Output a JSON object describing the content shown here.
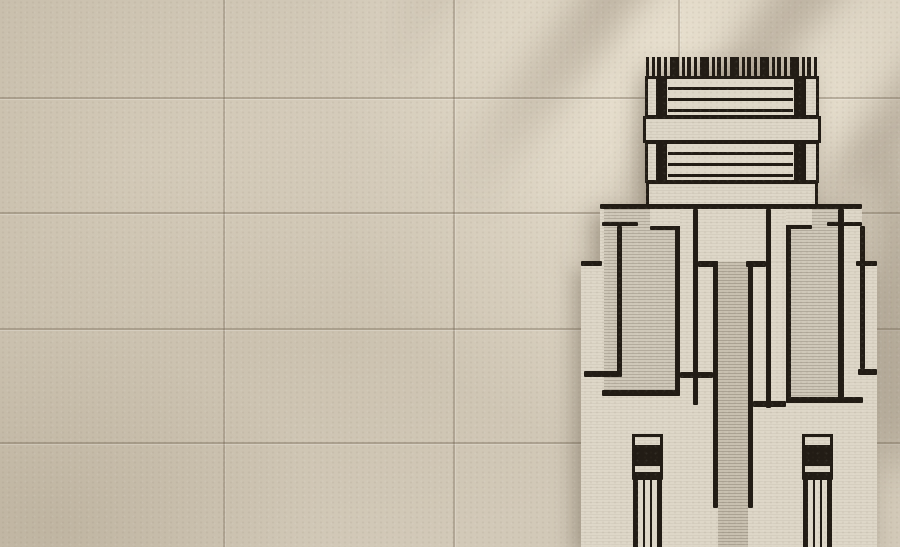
{
  "scene": {
    "description": "Beige limestone tile wall with a cream hand-tufted rug bearing a black Art Deco skyscraper motif",
    "colors": {
      "tile_base": "#d2c9b8",
      "tile_light": "#e8dfcd",
      "tile_dark": "#c7beac",
      "grout": "#746755",
      "rug_cream": "#ded7c8",
      "rug_ribbed": "#cfc8b9",
      "rug_ribbed_dark": "#c8c0b0",
      "rug_black": "#221c15"
    },
    "wall": {
      "grout_x": [
        223,
        453,
        678
      ],
      "grout_y": [
        97,
        212,
        328,
        442
      ]
    },
    "rug": {
      "left": 581,
      "top": 57,
      "right": 877,
      "bottom": 547,
      "rects": [
        {
          "name": "rug-body-shoulder",
          "x": 600,
          "y": 204,
          "w": 262,
          "h": 60,
          "cls": "cream"
        },
        {
          "name": "rug-body-main",
          "x": 581,
          "y": 262,
          "w": 296,
          "h": 285,
          "cls": "cream"
        },
        {
          "name": "body-top-outline",
          "x": 600,
          "y": 204,
          "w": 262,
          "h": 5,
          "cls": "black"
        },
        {
          "name": "left-step-outline",
          "x": 581,
          "y": 261,
          "w": 21,
          "h": 5,
          "cls": "black"
        },
        {
          "name": "right-step-outline",
          "x": 856,
          "y": 261,
          "w": 21,
          "h": 5,
          "cls": "black"
        },
        {
          "name": "left-tower-panel",
          "x": 604,
          "y": 209,
          "w": 71,
          "h": 181,
          "cls": "ribbed"
        },
        {
          "name": "left-tower-right-edge",
          "x": 675,
          "y": 209,
          "w": 5,
          "h": 187,
          "cls": "black"
        },
        {
          "name": "left-tower-bottom",
          "x": 602,
          "y": 390,
          "w": 78,
          "h": 6,
          "cls": "black"
        },
        {
          "name": "left-tower-notch",
          "x": 650,
          "y": 209,
          "w": 30,
          "h": 17,
          "cls": "cream"
        },
        {
          "name": "left-tower-notch-line",
          "x": 650,
          "y": 226,
          "w": 30,
          "h": 4,
          "cls": "black"
        },
        {
          "name": "left-outer-rect-top",
          "x": 602,
          "y": 222,
          "w": 36,
          "h": 4,
          "cls": "black"
        },
        {
          "name": "left-outer-rect-side",
          "x": 617,
          "y": 226,
          "w": 5,
          "h": 146,
          "cls": "black"
        },
        {
          "name": "left-outer-rect-bottom",
          "x": 584,
          "y": 371,
          "w": 38,
          "h": 6,
          "cls": "black"
        },
        {
          "name": "left-bar-line-a",
          "x": 693,
          "y": 209,
          "w": 5,
          "h": 196,
          "cls": "black"
        },
        {
          "name": "left-chamfer",
          "x": 698,
          "y": 261,
          "w": 20,
          "h": 6,
          "cls": "black"
        },
        {
          "name": "left-bar-line-b",
          "x": 713,
          "y": 261,
          "w": 5,
          "h": 144,
          "cls": "black"
        },
        {
          "name": "left-bars-bottom",
          "x": 680,
          "y": 372,
          "w": 33,
          "h": 6,
          "cls": "black"
        },
        {
          "name": "center-column",
          "x": 718,
          "y": 262,
          "w": 30,
          "h": 285,
          "cls": "ribbed-dark"
        },
        {
          "name": "center-column-left-edge",
          "x": 713,
          "y": 262,
          "w": 5,
          "h": 246,
          "cls": "black"
        },
        {
          "name": "center-column-right-edge",
          "x": 748,
          "y": 262,
          "w": 5,
          "h": 246,
          "cls": "black"
        },
        {
          "name": "right-chamfer",
          "x": 746,
          "y": 261,
          "w": 20,
          "h": 6,
          "cls": "black"
        },
        {
          "name": "right-bar-line-a",
          "x": 766,
          "y": 209,
          "w": 5,
          "h": 199,
          "cls": "black"
        },
        {
          "name": "right-bars-bottom",
          "x": 753,
          "y": 401,
          "w": 33,
          "h": 6,
          "cls": "black"
        },
        {
          "name": "right-tower-panel",
          "x": 791,
          "y": 209,
          "w": 47,
          "h": 188,
          "cls": "ribbed"
        },
        {
          "name": "right-tower-left-edge",
          "x": 786,
          "y": 209,
          "w": 5,
          "h": 194,
          "cls": "black"
        },
        {
          "name": "right-tower-right-edge",
          "x": 838,
          "y": 209,
          "w": 6,
          "h": 194,
          "cls": "black"
        },
        {
          "name": "right-tower-bottom",
          "x": 786,
          "y": 397,
          "w": 77,
          "h": 6,
          "cls": "black"
        },
        {
          "name": "right-tower-notch",
          "x": 786,
          "y": 209,
          "w": 26,
          "h": 16,
          "cls": "cream"
        },
        {
          "name": "right-tower-notch-line",
          "x": 786,
          "y": 225,
          "w": 26,
          "h": 4,
          "cls": "black"
        },
        {
          "name": "right-outer-rect-top",
          "x": 827,
          "y": 222,
          "w": 35,
          "h": 4,
          "cls": "black"
        },
        {
          "name": "right-outer-rect-side",
          "x": 860,
          "y": 226,
          "w": 5,
          "h": 143,
          "cls": "black"
        },
        {
          "name": "right-outer-rect-bottom",
          "x": 858,
          "y": 369,
          "w": 19,
          "h": 6,
          "cls": "black"
        },
        {
          "name": "left-column-cap",
          "x": 632,
          "y": 434,
          "w": 31,
          "h": 14,
          "cls": "outlined"
        },
        {
          "name": "left-column-black-band",
          "x": 632,
          "y": 447,
          "w": 31,
          "h": 17,
          "cls": "black"
        },
        {
          "name": "left-column-band",
          "x": 632,
          "y": 463,
          "w": 31,
          "h": 12,
          "cls": "outlined"
        },
        {
          "name": "left-column-thin-band",
          "x": 632,
          "y": 474,
          "w": 31,
          "h": 6,
          "cls": "black"
        },
        {
          "name": "left-column-pinstripes",
          "x": 633,
          "y": 480,
          "w": 29,
          "h": 67,
          "cls": "pinstripes"
        },
        {
          "name": "right-column-cap",
          "x": 802,
          "y": 434,
          "w": 31,
          "h": 14,
          "cls": "outlined"
        },
        {
          "name": "right-column-black-band",
          "x": 802,
          "y": 447,
          "w": 31,
          "h": 17,
          "cls": "black"
        },
        {
          "name": "right-column-band",
          "x": 802,
          "y": 463,
          "w": 31,
          "h": 12,
          "cls": "outlined"
        },
        {
          "name": "right-column-thin-band",
          "x": 802,
          "y": 474,
          "w": 31,
          "h": 6,
          "cls": "black"
        },
        {
          "name": "right-column-pinstripes",
          "x": 803,
          "y": 480,
          "w": 29,
          "h": 67,
          "cls": "pinstripes"
        },
        {
          "name": "crown-fringe",
          "x": 646,
          "y": 57,
          "w": 172,
          "h": 21,
          "cls": "fringe"
        },
        {
          "name": "crown-block-upper",
          "x": 645,
          "y": 76,
          "w": 174,
          "h": 42,
          "cls": "outlined"
        },
        {
          "name": "crown-upper-bar-left",
          "x": 656,
          "y": 78,
          "w": 11,
          "h": 38,
          "cls": "black"
        },
        {
          "name": "crown-upper-bar-right",
          "x": 794,
          "y": 78,
          "w": 12,
          "h": 38,
          "cls": "black"
        },
        {
          "name": "crown-upper-stripes",
          "x": 668,
          "y": 79,
          "w": 125,
          "h": 36,
          "cls": "hstripes"
        },
        {
          "name": "crown-cornice",
          "x": 643,
          "y": 116,
          "w": 178,
          "h": 27,
          "cls": "outlined"
        },
        {
          "name": "crown-block-lower",
          "x": 645,
          "y": 141,
          "w": 174,
          "h": 42,
          "cls": "outlined"
        },
        {
          "name": "crown-lower-bar-left",
          "x": 656,
          "y": 143,
          "w": 11,
          "h": 38,
          "cls": "black"
        },
        {
          "name": "crown-lower-bar-right",
          "x": 794,
          "y": 143,
          "w": 12,
          "h": 38,
          "cls": "black"
        },
        {
          "name": "crown-lower-stripes",
          "x": 668,
          "y": 144,
          "w": 125,
          "h": 36,
          "cls": "hstripes"
        },
        {
          "name": "crown-base-band",
          "x": 646,
          "y": 181,
          "w": 172,
          "h": 26,
          "cls": "outlined"
        }
      ]
    }
  }
}
